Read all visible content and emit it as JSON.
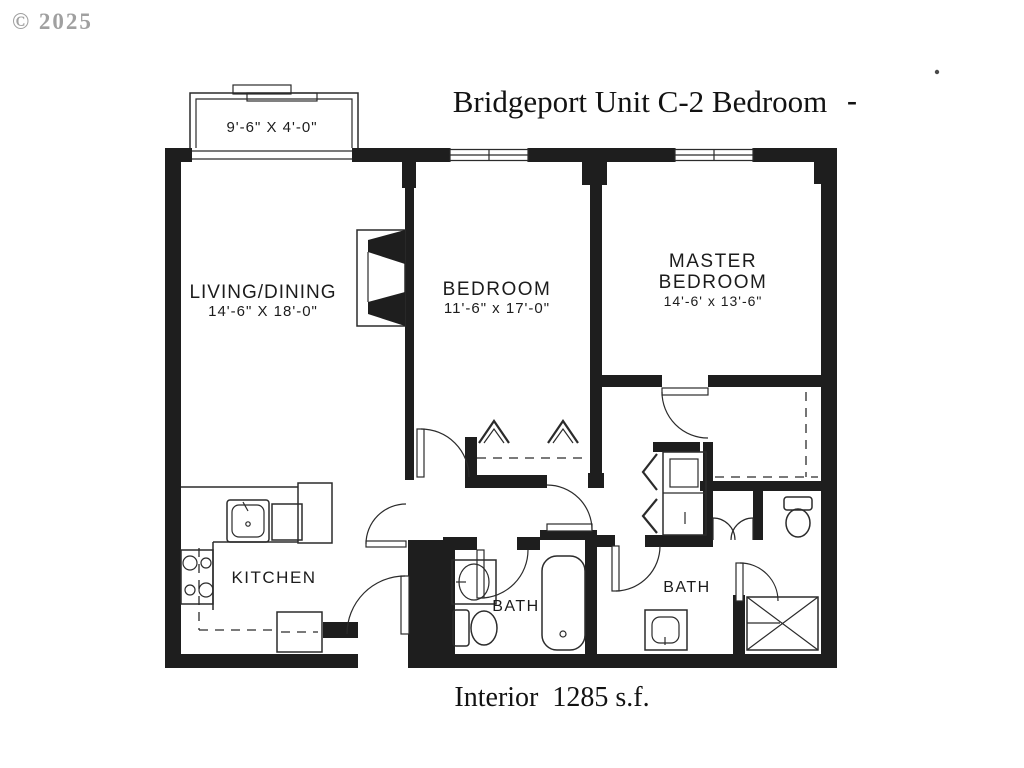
{
  "document": {
    "watermark": "© 2025",
    "title": "Bridgeport Unit C-2 Bedroom",
    "title_dash": "-",
    "footer": "Interior  1285 s.f."
  },
  "rooms": {
    "balcony": {
      "dims": "9'-6\" X 4'-0\""
    },
    "living_dining": {
      "name": "LIVING/DINING",
      "dims": "14'-6\" X 18'-0\""
    },
    "bedroom": {
      "name": "BEDROOM",
      "dims": "11'-6\" x 17'-0\""
    },
    "master_bedroom": {
      "name_line1": "MASTER",
      "name_line2": "BEDROOM",
      "dims": "14'-6' x 13'-6\""
    },
    "kitchen": {
      "name": "KITCHEN"
    },
    "bath_main": {
      "name": "BATH"
    },
    "bath_master": {
      "name": "BATH"
    }
  },
  "colors": {
    "wall": "#1e1e1e",
    "line": "#2b2b2b",
    "watermark": "#a0a0a0"
  }
}
